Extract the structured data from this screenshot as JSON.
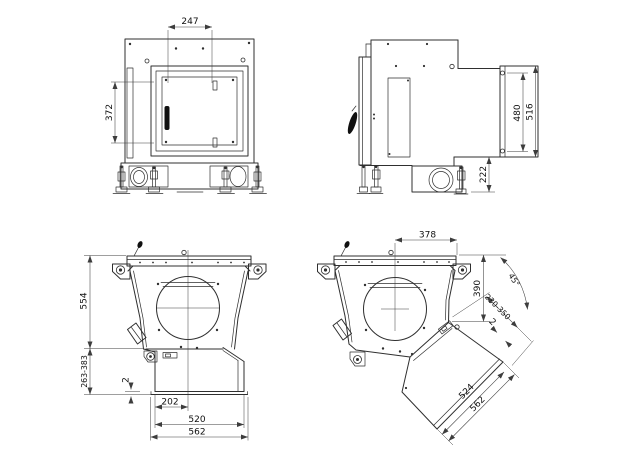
{
  "colors": {
    "background": "#ffffff",
    "line": "#2f2f2f",
    "dimension_line": "#3d3d3d",
    "text": "#0f0f0f"
  },
  "views": {
    "front": {
      "dims": {
        "opening_width": "247",
        "opening_height": "372"
      }
    },
    "side": {
      "dims": {
        "spigot_inner_height": "480",
        "spigot_outer_height": "516",
        "outlet_bottom_offset": "222"
      }
    },
    "bottom_straight": {
      "dims": {
        "body_height": "554",
        "adjustable_height": "263-383",
        "plate_gap": "2",
        "centre_offset": "202",
        "inner_width": "520",
        "overall_width": "562"
      }
    },
    "bottom_angled": {
      "dims": {
        "centre_to_edge": "378",
        "flange_height": "390",
        "chute_angle": "45°",
        "adjustable_length": "230-350",
        "plate_gap": "2",
        "inner_width": "524",
        "overall_width": "562"
      }
    }
  }
}
